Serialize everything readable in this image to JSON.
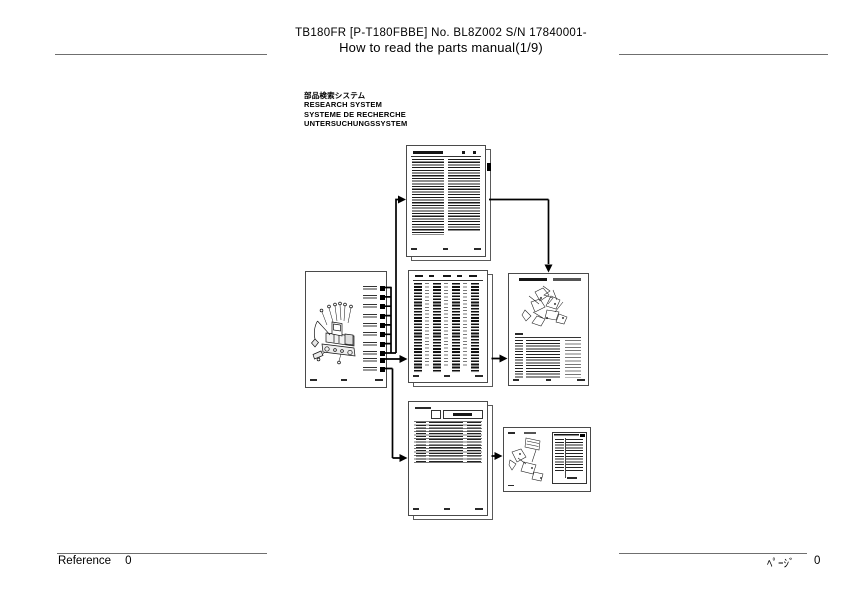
{
  "header": {
    "model_line": "TB180FR [P-T180FBBE] No. BL8Z002 S/N 17840001-",
    "title_line": "How to read the parts manual(1/9)"
  },
  "research_system": {
    "ja": "部品検索システム",
    "en": "RESEARCH SYSTEM",
    "fr": "SYSTEME DE RECHERCHE",
    "de": "UNTERSUCHUNGSSYSTEM"
  },
  "flow_diagram": {
    "thumbnails": [
      {
        "id": "machine-overview-page",
        "note": "excavator illustration with numbered section labels"
      },
      {
        "id": "table-of-contents-page",
        "visible_title": "TABLE OF CONTENTS"
      },
      {
        "id": "parts-index-page",
        "note": "dense multi-column index"
      },
      {
        "id": "parts-detail-page",
        "note": "exploded view with parts table"
      },
      {
        "id": "parts-list-page",
        "note": "parts table with header boxes"
      },
      {
        "id": "parts-detail-small-page",
        "note": "landscape exploded view with table"
      }
    ]
  },
  "footer": {
    "left_label": "Reference",
    "left_page_number": "0",
    "right_label": "ﾍﾟｰｼﾞ",
    "right_page_number": "0"
  },
  "colors": {
    "background": "#ffffff",
    "rule_gray": "#6f6f6f",
    "connector_black": "#000000",
    "page_border": "#4a4a4a"
  }
}
